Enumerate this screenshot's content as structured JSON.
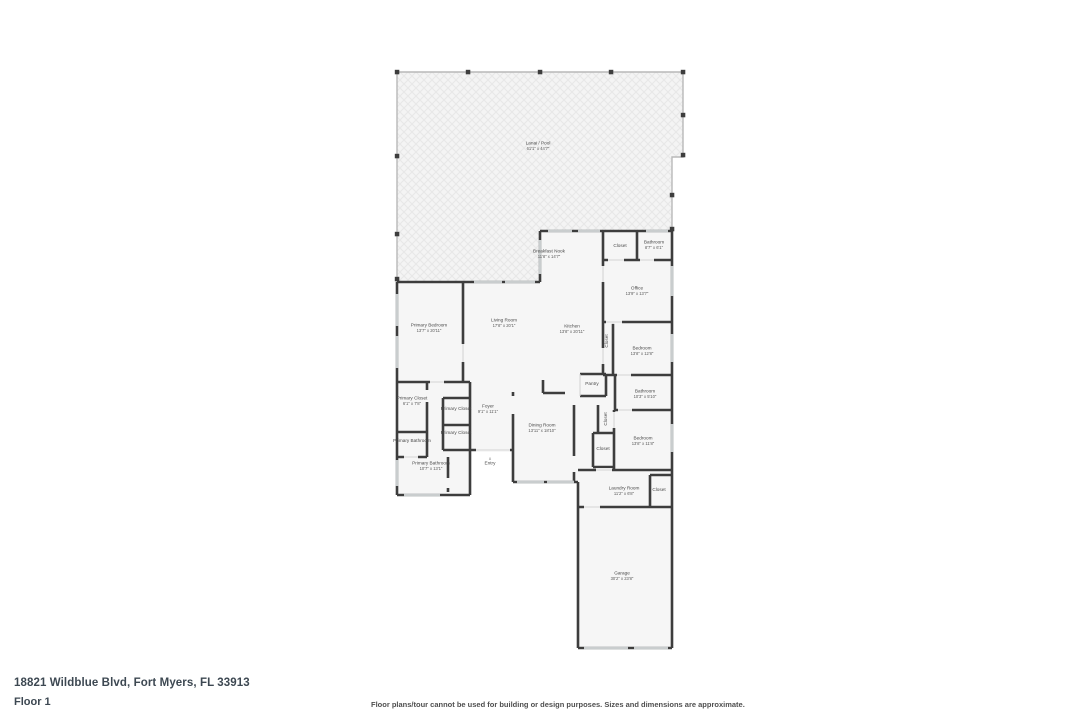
{
  "footer": {
    "address": "18821 Wildblue Blvd, Fort Myers, FL 33913",
    "floor": "Floor 1",
    "disclaimer": "Floor plans/tour cannot be used for building or design purposes. Sizes and dimensions are approximate."
  },
  "colors": {
    "wall": "#3d3d3d",
    "floor_fill": "#f6f6f6",
    "lanai_line": "#b8b8b8",
    "window": "#c9cdce",
    "label_text": "#4a4a4a"
  },
  "plan": {
    "entry_marker": "▵",
    "rooms": [
      {
        "name": "Lanai / Pool",
        "dims": "61'1\" x 44'7\"",
        "x": 538,
        "y": 146
      },
      {
        "name": "Breakfast Nook",
        "dims": "11'8\" x 14'7\"",
        "x": 549,
        "y": 254
      },
      {
        "name": "Closet",
        "x": 620,
        "y": 246
      },
      {
        "name": "Bathroom",
        "dims": "8'7\" x 6'1\"",
        "x": 654,
        "y": 245
      },
      {
        "name": "Office",
        "dims": "13'9\" x 13'7\"",
        "x": 637,
        "y": 291
      },
      {
        "name": "Living Room",
        "dims": "17'8\" x 20'1\"",
        "x": 504,
        "y": 323
      },
      {
        "name": "Kitchen",
        "dims": "13'8\" x 20'11\"",
        "x": 572,
        "y": 329
      },
      {
        "name": "Primary Bedroom",
        "dims": "13'7\" x 20'11\"",
        "x": 429,
        "y": 328
      },
      {
        "name": "Primary Closet",
        "dims": "6'1\" x 7'8\"",
        "x": 412,
        "y": 401
      },
      {
        "name": "Primary Closet",
        "x": 456,
        "y": 409
      },
      {
        "name": "Primary Closet",
        "x": 456,
        "y": 433
      },
      {
        "name": "Primary Bathroom",
        "x": 412,
        "y": 441
      },
      {
        "name": "Foyer",
        "dims": "9'1\" x 11'1\"",
        "x": 488,
        "y": 409
      },
      {
        "name": "Primary Bathroom",
        "dims": "10'7\" x 13'1\"",
        "x": 431,
        "y": 466
      },
      {
        "name": "Entry",
        "x": 490,
        "y": 461,
        "icon": true
      },
      {
        "name": "Dining Room",
        "dims": "13'11\" x 18'10\"",
        "x": 542,
        "y": 428
      },
      {
        "name": "Pantry",
        "x": 592,
        "y": 384
      },
      {
        "name": "Closet",
        "x": 607,
        "y": 341,
        "rot": true
      },
      {
        "name": "Bedroom",
        "dims": "13'8\" x 12'8\"",
        "x": 642,
        "y": 351
      },
      {
        "name": "Bathroom",
        "dims": "10'3\" x 5'10\"",
        "x": 645,
        "y": 394
      },
      {
        "name": "Closet",
        "x": 606,
        "y": 419,
        "rot": true
      },
      {
        "name": "Bedroom",
        "dims": "13'8\" x 11'8\"",
        "x": 643,
        "y": 441
      },
      {
        "name": "Closet",
        "x": 603,
        "y": 449
      },
      {
        "name": "Laundry Room",
        "dims": "11'2\" x 6'8\"",
        "x": 624,
        "y": 491
      },
      {
        "name": "Closet",
        "x": 659,
        "y": 490
      },
      {
        "name": "Garage",
        "dims": "30'2\" x 23'8\"",
        "x": 622,
        "y": 576
      }
    ]
  }
}
